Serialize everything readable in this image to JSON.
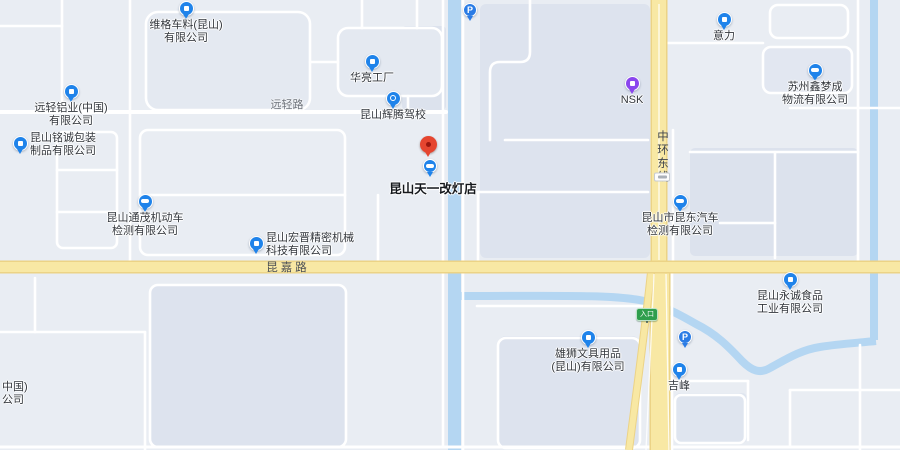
{
  "map": {
    "colors": {
      "background": "#e9edf3",
      "parcel": "#dde3ee",
      "parcel_dark": "#d9e0eb",
      "road_minor": "#ffffff",
      "road_major_fill": "#f8e8a4",
      "road_major_casing": "#ecd386",
      "water": "#b4d6f2",
      "poi_blue": "#1f83ea",
      "poi_purple": "#8a46ee",
      "parking_blue": "#2b7ce5",
      "pin_red": "#e5452f",
      "pin_red_dark": "#99170e",
      "entrance_green": "#2f9e4d"
    },
    "destination": {
      "label": "昆山天一改灯店",
      "pin": {
        "x": 428,
        "y": 148
      },
      "icon": {
        "x": 430,
        "y": 168,
        "glyph": "car-icon"
      },
      "label_pos": {
        "x": 433,
        "y": 178
      }
    },
    "pois": [
      {
        "id": "weige",
        "lines": "维格车料(昆山)\n有限公司",
        "icon": "company-icon",
        "x": 186,
        "y": 10,
        "label": "below"
      },
      {
        "id": "yuanqing-lvye",
        "lines": "远轻铝业(中国)\n有限公司",
        "icon": "company-icon",
        "x": 71,
        "y": 93,
        "label": "below"
      },
      {
        "id": "mingcheng",
        "lines": "昆山铭诚包装\n制品有限公司",
        "icon": "company-icon",
        "x": 20,
        "y": 145,
        "label": "right"
      },
      {
        "id": "hualiang",
        "lines": "华亮工厂",
        "icon": "factory-icon",
        "x": 372,
        "y": 63,
        "label": "below"
      },
      {
        "id": "huiteng",
        "lines": "昆山辉腾驾校",
        "icon": "driving-school-icon",
        "x": 393,
        "y": 100,
        "label": "below"
      },
      {
        "id": "tongmao",
        "lines": "昆山通茂机动车\n检测有限公司",
        "icon": "car-icon",
        "x": 145,
        "y": 203,
        "label": "below"
      },
      {
        "id": "hongjin",
        "lines": "昆山宏晋精密机械\n科技有限公司",
        "icon": "company-icon",
        "x": 256,
        "y": 245,
        "label": "right"
      },
      {
        "id": "nsk",
        "lines": "NSK",
        "icon": "nsk-icon",
        "x": 632,
        "y": 85,
        "label": "below",
        "color": "#8a46ee"
      },
      {
        "id": "yili",
        "lines": "意力",
        "icon": "company-icon",
        "x": 724,
        "y": 21,
        "label": "below"
      },
      {
        "id": "xinmengcheng",
        "lines": "苏州鑫梦成\n物流有限公司",
        "icon": "truck-icon",
        "x": 815,
        "y": 72,
        "label": "below"
      },
      {
        "id": "kundong",
        "lines": "昆山市昆东汽车\n检测有限公司",
        "icon": "car-icon",
        "x": 680,
        "y": 203,
        "label": "below"
      },
      {
        "id": "yongcheng",
        "lines": "昆山永诚食品\n工业有限公司",
        "icon": "company-icon",
        "x": 790,
        "y": 281,
        "label": "below"
      },
      {
        "id": "xiongshi",
        "lines": "雄狮文具用品\n(昆山)有限公司",
        "icon": "company-icon",
        "x": 588,
        "y": 339,
        "label": "below"
      },
      {
        "id": "jifeng",
        "lines": "吉峰",
        "icon": "company-icon",
        "x": 679,
        "y": 371,
        "label": "below"
      }
    ],
    "parking": [
      {
        "id": "parking-north",
        "label": "P",
        "x": 470,
        "y": 12
      },
      {
        "id": "parking-south",
        "label": "P",
        "x": 685,
        "y": 339
      }
    ],
    "road_labels": [
      {
        "id": "yuanqing-road",
        "text": "远轻路",
        "x": 287,
        "y": 104,
        "style": "minor-h"
      },
      {
        "id": "kunjia-road",
        "text": "昆嘉路",
        "x": 288,
        "y": 267,
        "style": "major-h"
      },
      {
        "id": "zhonghuan-east",
        "text": "中环东线",
        "x": 662,
        "y": 130,
        "style": "major-v"
      }
    ],
    "road_shield": {
      "x": 662,
      "y": 177
    },
    "entrance_badge": {
      "label": "入口",
      "x": 647,
      "y": 308
    },
    "partial_label": {
      "lines": "中国)\n公司",
      "x": 2,
      "y": 381
    }
  }
}
